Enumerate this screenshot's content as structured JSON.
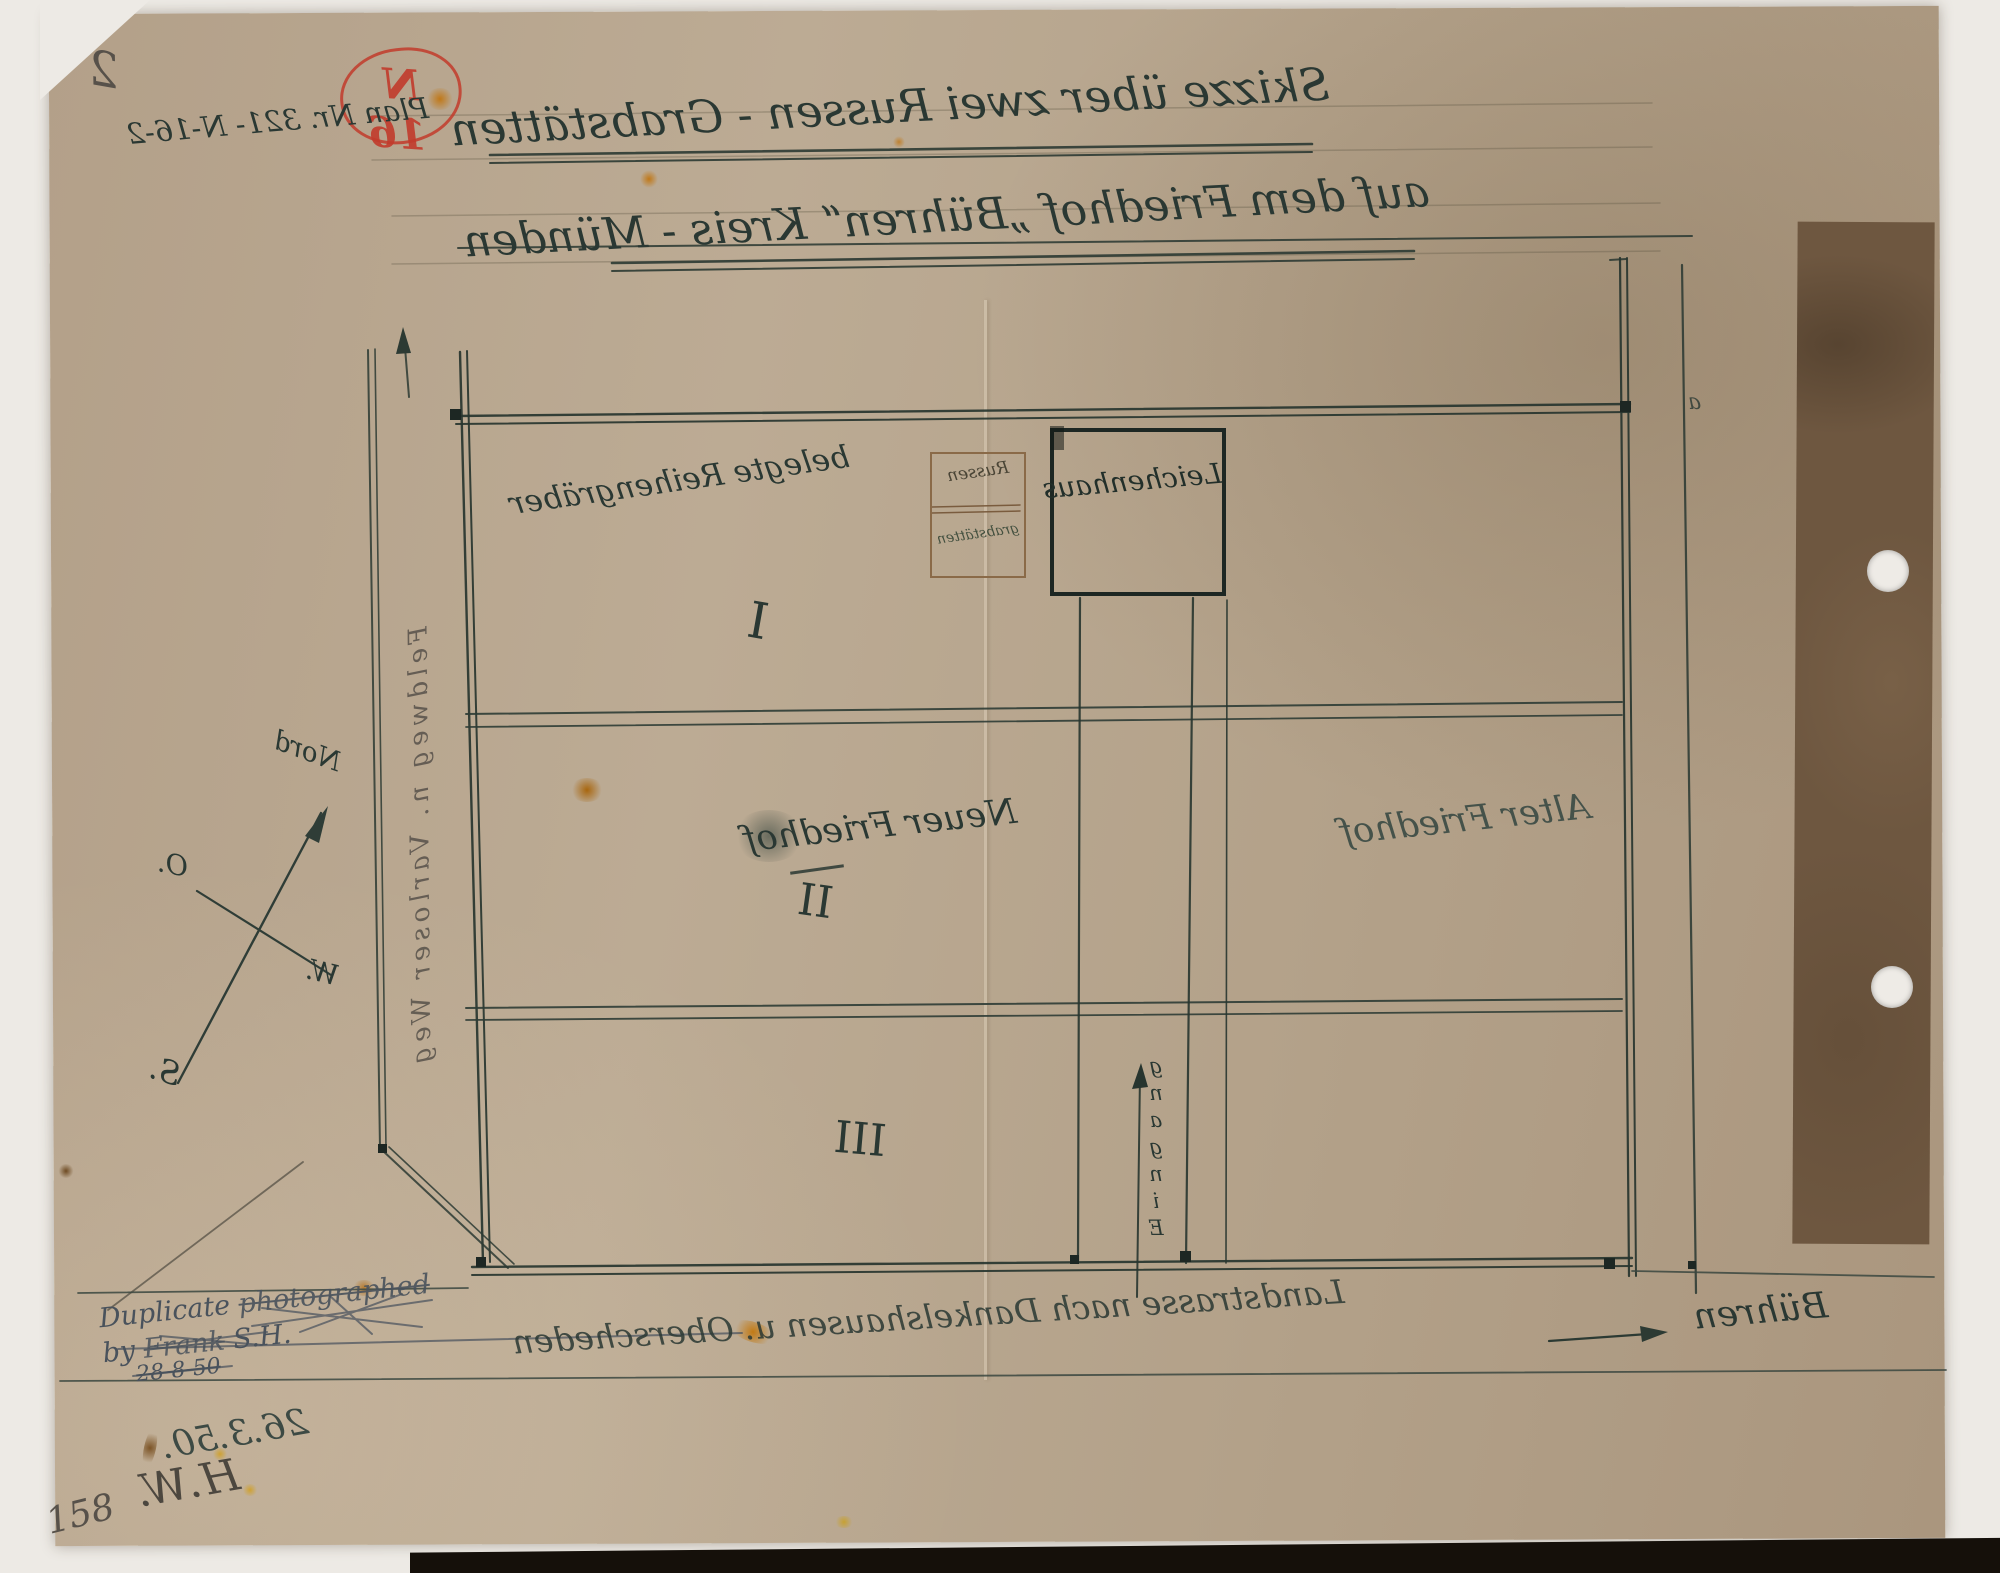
{
  "stamp": {
    "text": "N 16"
  },
  "title": {
    "line1": "Skizze über zwei Russen - Grabstätten",
    "line2": "auf dem Friedhof „Bühren“ Kreis - Münden"
  },
  "annotations": {
    "page_number": "2",
    "plan_number": "Plan Nr. 321- N-16-2",
    "corner_number": "158",
    "date_note": "26.3.50.",
    "initials": "H.W.",
    "fence_mark": "a",
    "duplicate_note": {
      "line1_prefix": "Duplicate",
      "line1_struck": "photographed",
      "line2_prefix": "by",
      "line2_struck": "Frank",
      "line2_suffix": "S.H.",
      "line3": "28-8-50"
    }
  },
  "plan": {
    "sections": {
      "one_numeral": "I",
      "one_label": "belegte Reihengräber",
      "two_numeral": "II",
      "two_label": "Neuer Friedhof",
      "three_numeral": "III",
      "alter_friedhof": "Alter Friedhof"
    },
    "russen_box": {
      "line1": "Russen",
      "line2": "grabstätten"
    },
    "leichenhaus": "Leichenhaus",
    "eingang": "Eingang",
    "roads": {
      "left_road": "Feldweg n. Varloser Weg",
      "bottom_road": "Landstrasse nach Dankelshausen u. Oberscheden",
      "destination": "Bühren"
    }
  },
  "compass": {
    "north": "Nord",
    "east": "O.",
    "west": "W.",
    "south": "S."
  },
  "colors": {
    "ink": "#2a3833",
    "pencil": "#57514a",
    "stamp_red": "#c23b2c",
    "paper": "#b7a48c",
    "brown_ink": "#7a5c3e",
    "tape_brown": "#6e5740"
  }
}
